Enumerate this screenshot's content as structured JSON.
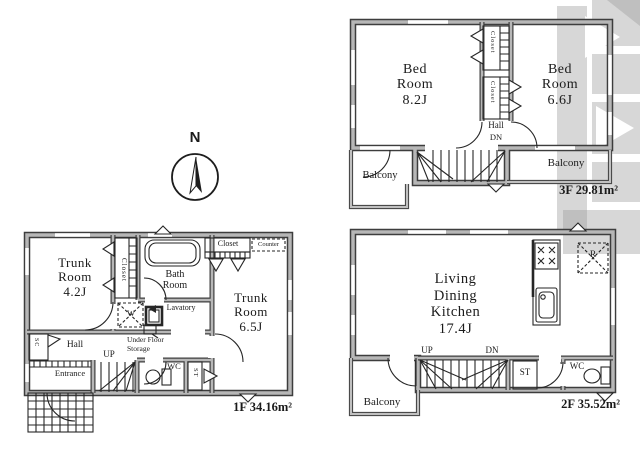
{
  "colors": {
    "wall": "#3d3d3d",
    "wall_fill": "#b7b7b7",
    "ink": "#1b1b1b",
    "watermark": "#9a9a9a"
  },
  "compass": {
    "north_label": "N"
  },
  "floor_3f": {
    "area_label": "3F 29.81m²",
    "bedroom_left": {
      "line1": "Bed",
      "line2": "Room",
      "line3": "8.2J"
    },
    "bedroom_right": {
      "line1": "Bed",
      "line2": "Room",
      "line3": "6.6J"
    },
    "closet_upper": "Closet",
    "closet_lower": "Closet",
    "hall": "Hall",
    "dn": "DN",
    "balcony_left": "Balcony",
    "balcony_right": "Balcony"
  },
  "floor_2f": {
    "area_label": "2F 35.52m²",
    "ldk": {
      "line1": "Living",
      "line2": "Dining",
      "line3": "Kitchen",
      "line4": "17.4J"
    },
    "up": "UP",
    "dn": "DN",
    "storage": "ST",
    "wc": "WC",
    "refrigerator": "R",
    "balcony": "Balcony"
  },
  "floor_1f": {
    "area_label": "1F 34.16m²",
    "trunk_room_left": {
      "line1": "Trunk",
      "line2": "Room",
      "line3": "4.2J"
    },
    "trunk_room_right": {
      "line1": "Trunk",
      "line2": "Room",
      "line3": "6.5J"
    },
    "closet_column": "Closet",
    "closet_top": "Closet",
    "counter": "Counter",
    "bath": {
      "line1": "Bath",
      "line2": "Room"
    },
    "washer": "W",
    "lavatory": "Lavatory",
    "under_floor_storage": {
      "line1": "Under Floor",
      "line2": "Storage"
    },
    "hall": "Hall",
    "shoe_closet": "SC",
    "up": "UP",
    "entrance": "Entrance",
    "wc": "WC",
    "storage": "ST"
  }
}
